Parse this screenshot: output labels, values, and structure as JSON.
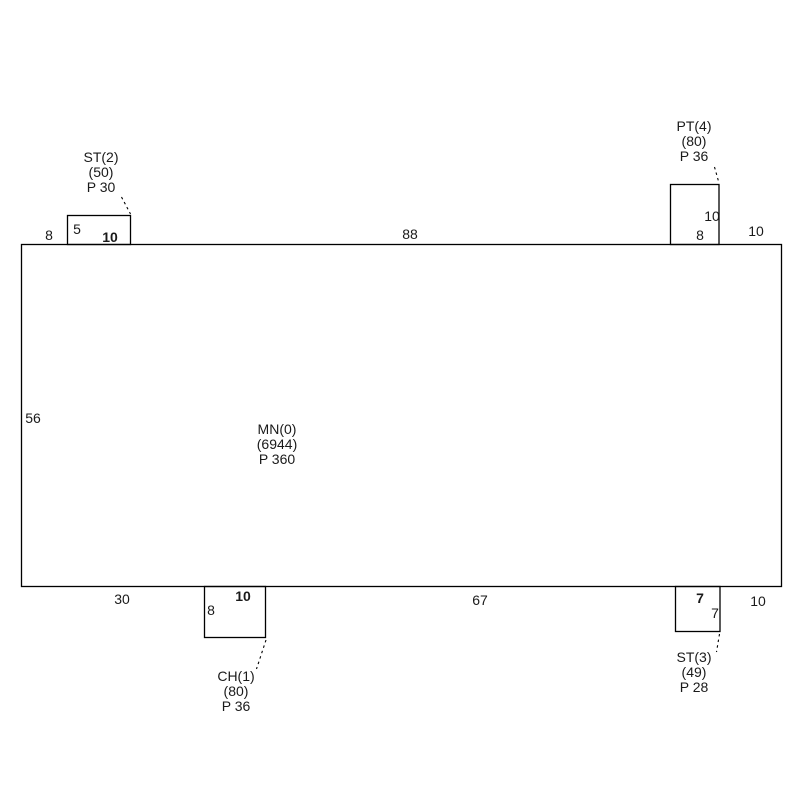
{
  "rooms": {
    "main": {
      "name": "MN(0)",
      "area": "(6944)",
      "perimeter": "P 360"
    },
    "st2": {
      "name": "ST(2)",
      "area": "(50)",
      "perimeter": "P 30"
    },
    "pt4": {
      "name": "PT(4)",
      "area": "(80)",
      "perimeter": "P 36"
    },
    "ch1": {
      "name": "CH(1)",
      "area": "(80)",
      "perimeter": "P 36"
    },
    "st3": {
      "name": "ST(3)",
      "area": "(49)",
      "perimeter": "P 28"
    }
  },
  "dimensions": {
    "top_left_offset": "8",
    "st2_height": "5",
    "st2_width": "10",
    "top_span": "88",
    "pt4_height": "10",
    "pt4_width": "8",
    "top_right_offset": "10",
    "main_left_height": "56",
    "bottom_left_offset": "30",
    "ch1_height": "8",
    "ch1_width": "10",
    "bottom_span": "67",
    "st3_width": "7",
    "st3_height": "7",
    "bottom_right_offset": "10"
  },
  "colors": {
    "line": "#000000",
    "text": "#1a1a1a",
    "background": "#ffffff"
  }
}
